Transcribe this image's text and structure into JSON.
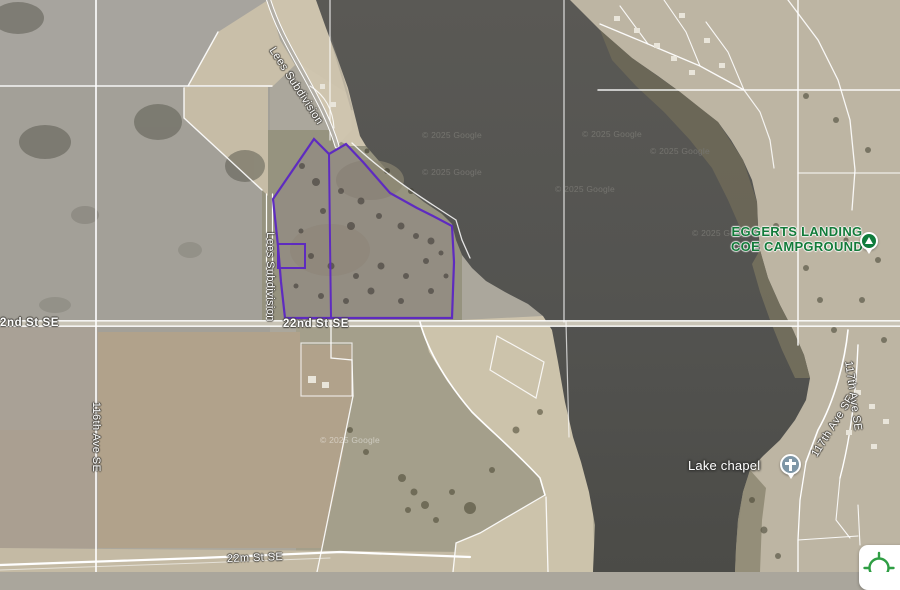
{
  "attribution": "© 2025 Google",
  "road_labels": {
    "lees_subdivision": "Lees Subdivision",
    "st_22nd_se": "22nd St SE",
    "ave_116th_se": "116th Ave SE",
    "st_22m_se": "22m St SE",
    "ave_117th_se": "117th Ave SE"
  },
  "pois": {
    "campground": {
      "line1": "EGGERTS LANDING",
      "line2": "COE CAMPGROUND"
    },
    "chapel": {
      "label": "Lake chapel"
    }
  },
  "parcel": {
    "outline_color": "#5e2bc0"
  },
  "colors": {
    "water": "#545450",
    "poi_green": "#137b3a",
    "panel": "#ffffff",
    "crosshair_green": "#2f9e44"
  }
}
